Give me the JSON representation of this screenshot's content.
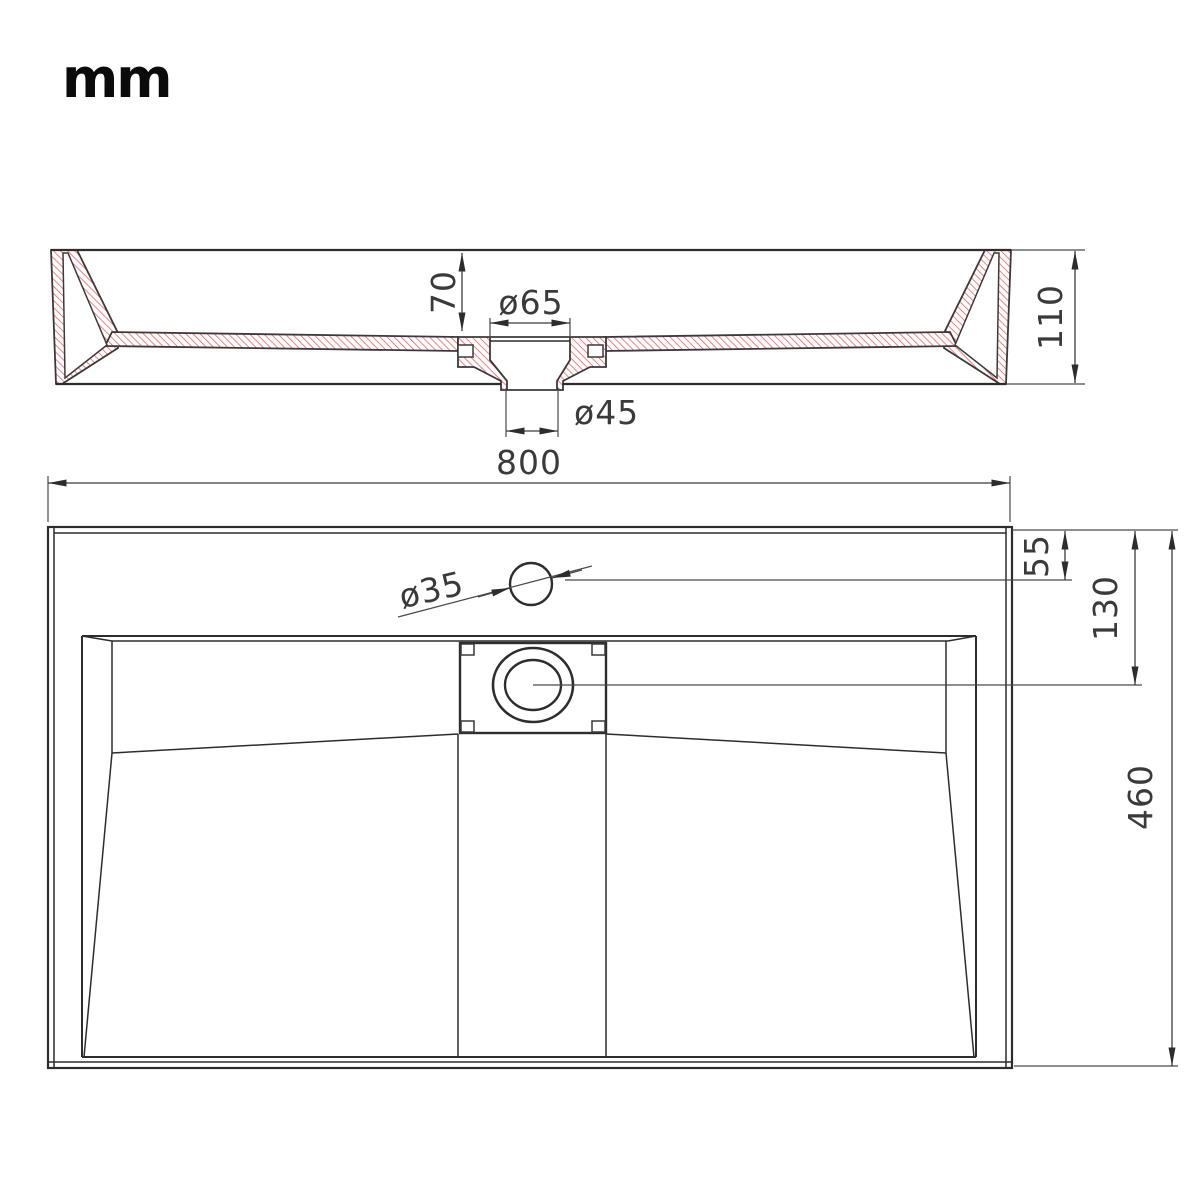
{
  "unit_label": "mm",
  "section_view": {
    "basin_depth": "70",
    "drain_recess_diameter": "ø65",
    "drain_outlet_diameter": "ø45",
    "overall_height": "110"
  },
  "plan_view": {
    "overall_width": "800",
    "faucet_hole_diameter": "ø35",
    "faucet_hole_offset": "55",
    "drain_center_offset": "130",
    "overall_depth": "460"
  },
  "colors": {
    "hatch_red": "#f0545c",
    "outline": "#2d2d2d",
    "dimension_text": "#3a3a3a"
  }
}
